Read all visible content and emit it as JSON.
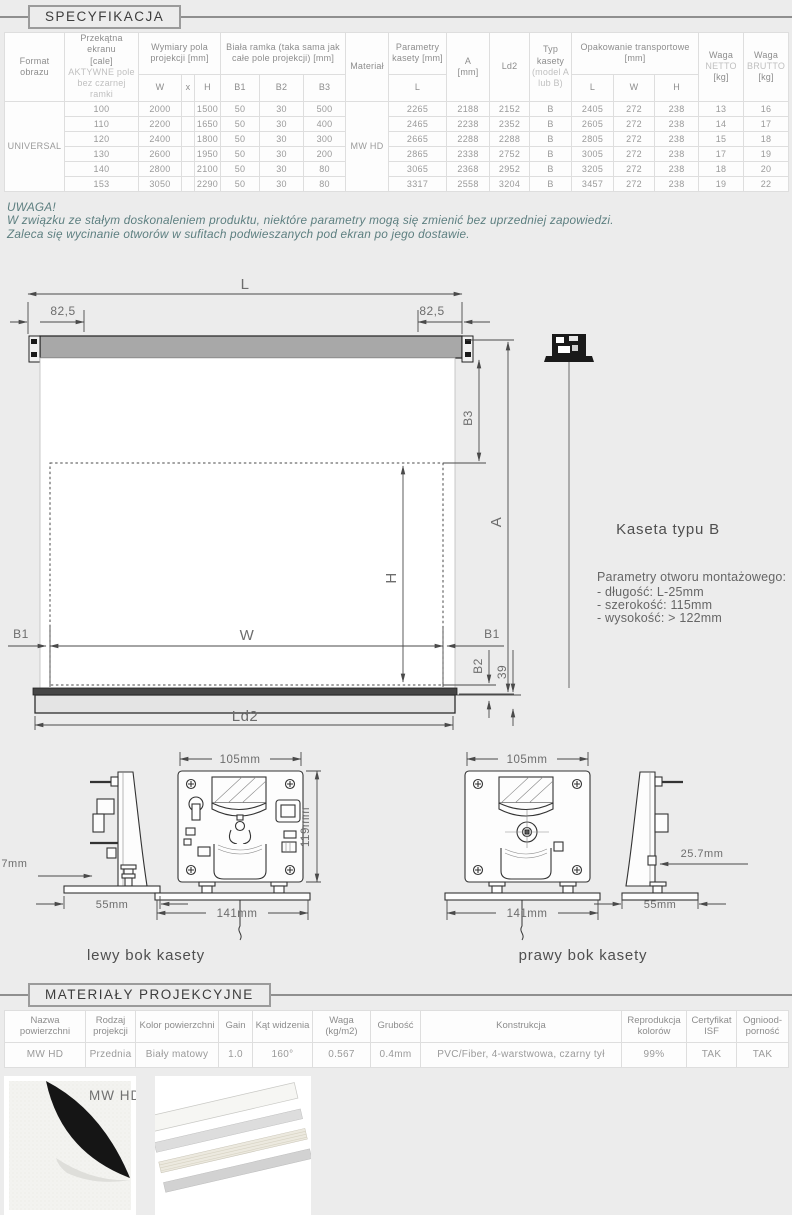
{
  "page": {
    "section1_title": "SPECYFIKACJA",
    "section2_title": "MATERIAŁY PROJEKCYJNE"
  },
  "spec_table": {
    "h_format": "Format obrazu",
    "h_diag_1": "Przekątna ekranu",
    "h_diag_2": "[cale]",
    "h_diag_3": "AKTYWNE pole",
    "h_diag_4": "bez czarnej ramki",
    "h_dims": "Wymiary pola projekcji [mm]",
    "h_dims_w": "W",
    "h_dims_x": "x",
    "h_dims_h": "H",
    "h_frame": "Biała ramka (taka sama jak całe pole projekcji) [mm]",
    "h_b1": "B1",
    "h_b2": "B2",
    "h_b3": "B3",
    "h_material": "Materiał",
    "h_cassette": "Parametry kasety [mm]",
    "h_cassette_l": "L",
    "h_a_1": "A",
    "h_a_2": "[mm]",
    "h_ld2": "Ld2",
    "h_type_1": "Typ",
    "h_type_2": "kasety",
    "h_type_3": "(model A",
    "h_type_4": "lub B)",
    "h_pack": "Opakowanie transportowe [mm]",
    "h_pack_l": "L",
    "h_pack_w": "W",
    "h_pack_h": "H",
    "h_netto_1": "Waga",
    "h_netto_2": "NETTO",
    "h_netto_3": "[kg]",
    "h_brutto_1": "Waga",
    "h_brutto_2": "BRUTTO",
    "h_brutto_3": "[kg]",
    "format_value": "UNIVERSAL",
    "material_value": "MW HD",
    "rows": [
      [
        "100",
        "2000",
        "1500",
        "50",
        "30",
        "500",
        "2265",
        "2188",
        "2152",
        "B",
        "2405",
        "272",
        "238",
        "13",
        "16"
      ],
      [
        "110",
        "2200",
        "1650",
        "50",
        "30",
        "400",
        "2465",
        "2238",
        "2352",
        "B",
        "2605",
        "272",
        "238",
        "14",
        "17"
      ],
      [
        "120",
        "2400",
        "1800",
        "50",
        "30",
        "300",
        "2665",
        "2288",
        "2288",
        "B",
        "2805",
        "272",
        "238",
        "15",
        "18"
      ],
      [
        "130",
        "2600",
        "1950",
        "50",
        "30",
        "200",
        "2865",
        "2338",
        "2752",
        "B",
        "3005",
        "272",
        "238",
        "17",
        "19"
      ],
      [
        "140",
        "2800",
        "2100",
        "50",
        "30",
        "80",
        "3065",
        "2368",
        "2952",
        "B",
        "3205",
        "272",
        "238",
        "18",
        "20"
      ],
      [
        "153",
        "3050",
        "2290",
        "50",
        "30",
        "80",
        "3317",
        "2558",
        "3204",
        "B",
        "3457",
        "272",
        "238",
        "19",
        "22"
      ]
    ]
  },
  "notice": {
    "title": "UWAGA!",
    "line1": "W związku ze stałym doskonaleniem produktu, niektóre parametry mogą się zmienić bez uprzedniej zapowiedzi.",
    "line2": "Zaleca się wycinanie otworów w sufitach podwieszanych pod ekran po jego dostawie."
  },
  "diagram": {
    "dim_l": "L",
    "dim_825_left": "82,5",
    "dim_825_right": "82,5",
    "dim_b3": "B3",
    "dim_a": "A",
    "dim_h": "H",
    "dim_w": "W",
    "dim_b1_left": "B1",
    "dim_b1_right": "B1",
    "dim_b2": "B2",
    "dim_39": "39",
    "dim_ld2": "Ld2",
    "cassette_type": "Kaseta typu B",
    "mount_title": "Parametry otworu montażowego:",
    "mount_item1": "- długość: L-25mm",
    "mount_item2": "- szerokość: 115mm",
    "mount_item3": "- wysokość: > 122mm"
  },
  "cassette_views": {
    "left_label": "lewy bok kasety",
    "right_label": "prawy bok kasety",
    "left_dim_105": "105mm",
    "left_dim_119": "119mm",
    "left_dim_141": "141mm",
    "left_dim_55": "55mm",
    "left_dim_257": "25.7mm",
    "right_dim_105": "105mm",
    "right_dim_141": "141mm",
    "right_dim_55": "55mm",
    "right_dim_257": "25.7mm"
  },
  "materials_table": {
    "headers": [
      "Nazwa powierzchni",
      "Rodzaj projekcji",
      "Kolor powierzchni",
      "Gain",
      "Kąt widzenia",
      "Waga (kg/m2)",
      "Grubość",
      "Konstrukcja",
      "Reprodukcja kolorów",
      "Certyfikat ISF",
      "Ogniood- porność"
    ],
    "row": [
      "MW HD",
      "Przednia",
      "Biały matowy",
      "1.0",
      "160°",
      "0.567",
      "0.4mm",
      "PVC/Fiber, 4-warstwowa, czarny tył",
      "99%",
      "TAK",
      "TAK"
    ]
  },
  "samples": {
    "material_label": "MW HD"
  }
}
